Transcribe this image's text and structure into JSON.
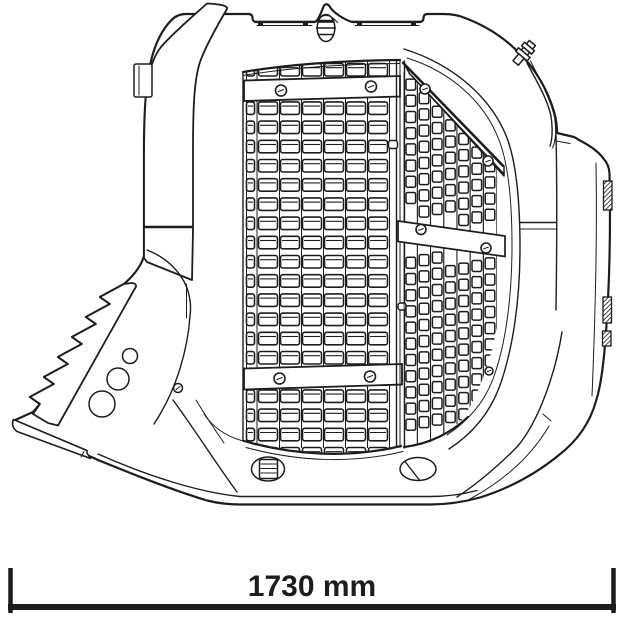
{
  "figure": {
    "subject": "screening-bucket-technical-drawing",
    "background": "#ffffff",
    "line_color": "#1d1d1b"
  },
  "dimension": {
    "label": "1730 mm",
    "value": 1730,
    "unit": "mm"
  },
  "front_grid": {
    "row_start": 63.5,
    "row_pitch": 19.2,
    "row_count": 21,
    "slot_height": 12.5,
    "columns": [
      {
        "x": 246.5,
        "w": 8
      },
      {
        "x": 258.5,
        "w": 19
      },
      {
        "x": 280.5,
        "w": 19
      },
      {
        "x": 302.5,
        "w": 19
      },
      {
        "x": 324.5,
        "w": 19
      },
      {
        "x": 346.5,
        "w": 19
      },
      {
        "x": 368.5,
        "w": 19
      }
    ],
    "separators_x": [
      257,
      279.5,
      301.5,
      323.5,
      345.5,
      367.5,
      389.5
    ],
    "bars": [
      {
        "points": "244,80.5 400,76 400,96.5 244,101",
        "bolts": [
          [
            281,
            90.5
          ],
          [
            371,
            86.5
          ]
        ]
      },
      {
        "points": "244,368.5 402,364 402,384.5 244,389.5",
        "bolts": [
          [
            279.5,
            378.5
          ],
          [
            370,
            376.5
          ]
        ]
      }
    ],
    "bolt_radius": 5.5
  },
  "side_grid": {
    "x0": 406,
    "col_pitch": 13.2,
    "cols": 7,
    "hole_w": 9.6,
    "hole_h": 11,
    "row_pitch": 16.2,
    "top_line_x": 403,
    "top_line_y": 63,
    "top_slope": 1.03,
    "hole_top_offset": 13,
    "bottom_y_at_x0": 445,
    "bottom_slope": -0.38,
    "bar": {
      "points": "398,221 505,236 505,256.5 398,241.5",
      "bolts": [
        [
          421,
          229.5
        ],
        [
          486,
          248
        ]
      ]
    },
    "top_band_bolts": [
      [
        425,
        89
      ],
      [
        488,
        161
      ]
    ],
    "extra_bolt": [
      489,
      371
    ],
    "bolt_radius": 5
  }
}
